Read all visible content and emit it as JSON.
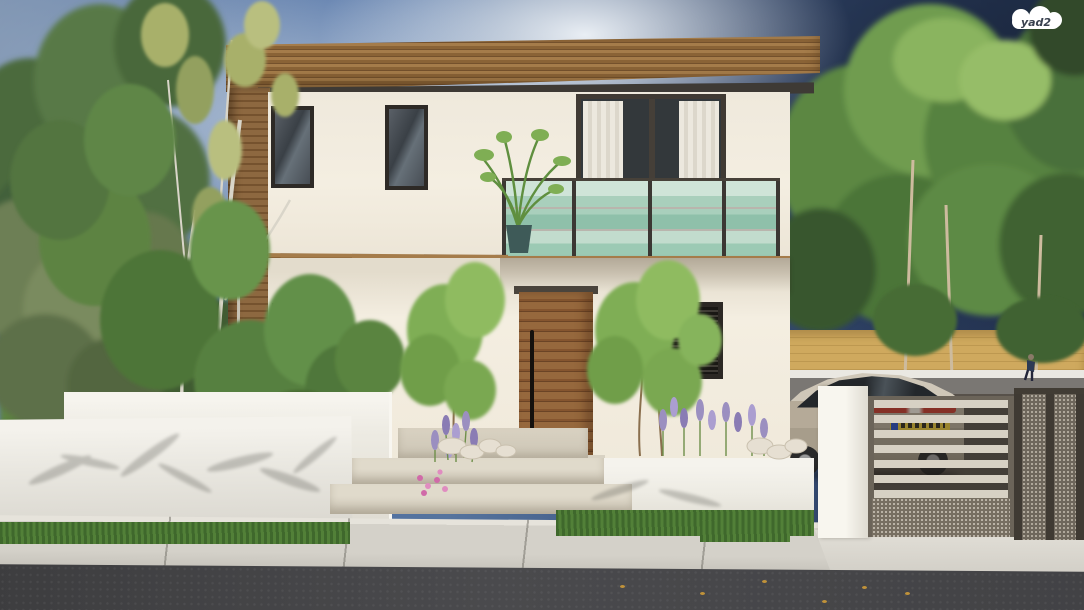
{
  "watermark": {
    "label": "yad2"
  },
  "palette": {
    "sky_left": "#6c84a6",
    "sky_right": "#233350",
    "foliage_light": "#8fbb61",
    "foliage_mid": "#578240",
    "foliage_dark": "#3a5530",
    "wood": "#8a6336",
    "stucco": "#f4eee1",
    "frame_dark": "#2e2a26",
    "balcony_glass": "#a9cfbc",
    "door_wood": "#85552f",
    "planter_white": "#edebe3",
    "boundary_yellow": "#cfa95e",
    "gate_taupe": "#968d80",
    "car_body": "#b5aa98",
    "plate_yellow": "#e2c33c",
    "tail_light_red": "#c23b2e",
    "sidewalk": "#d4d1c9",
    "road": "#4a4a4d",
    "lavender": "#9b8fc0",
    "grass": "#528038"
  }
}
